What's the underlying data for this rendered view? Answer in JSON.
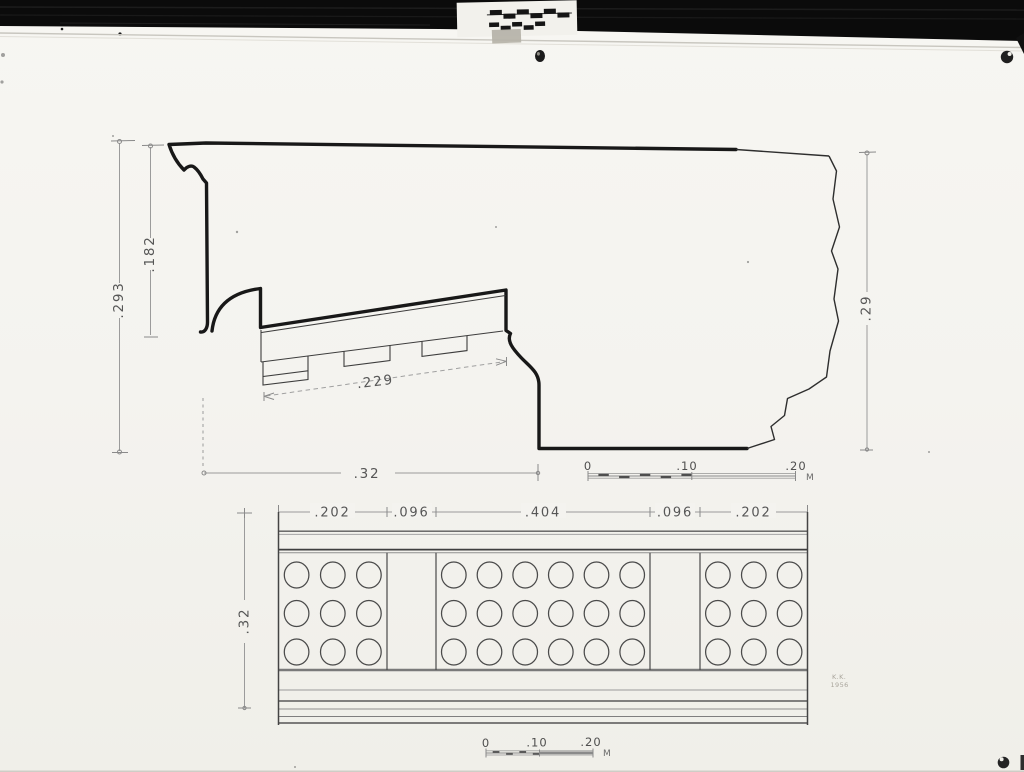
{
  "colors": {
    "paper": "#f4f3ef",
    "ink": "#181818",
    "dim_line": "#9b9b9b",
    "label_ink": "#565656",
    "film_black": "#0b0b0b"
  },
  "section_drawing": {
    "dim_left_outer": ".293",
    "dim_left_inner": ".182",
    "dim_soffit": ".229",
    "dim_bottom": ".32",
    "dim_right": ".29",
    "scale_bar": {
      "zero": "0",
      "ten": ".10",
      "twenty": ".20",
      "unit": "M"
    }
  },
  "plan_drawing": {
    "dims_top": [
      ".202",
      ".096",
      ".404",
      ".096",
      ".202"
    ],
    "dim_left": ".32",
    "scale_bar": {
      "zero": "0",
      "ten": ".10",
      "twenty": ".20",
      "unit": "M"
    },
    "gutta_panels": [
      {
        "columns": 3,
        "rows": 3
      },
      {
        "columns": 6,
        "rows": 3
      },
      {
        "columns": 3,
        "rows": 3
      }
    ]
  },
  "signature": {
    "initials": "K.K.",
    "year": "1956"
  }
}
